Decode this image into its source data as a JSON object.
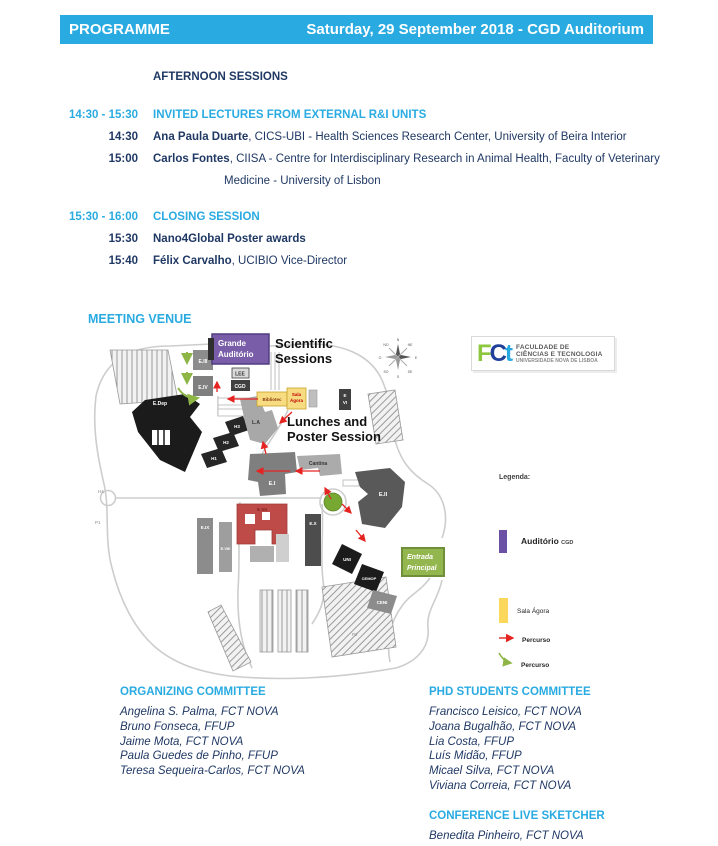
{
  "header": {
    "left": "PROGRAMME",
    "right": "Saturday, 29 September 2018 - CGD Auditorium"
  },
  "schedule": {
    "section_title": "AFTERNOON SESSIONS",
    "blocks": [
      {
        "time": "14:30 - 15:30",
        "title": "INVITED LECTURES FROM EXTERNAL R&I UNITS",
        "items": [
          {
            "time": "14:30",
            "bold": "Ana Paula Duarte",
            "normal": ", CICS-UBI - Health Sciences Research Center, University of Beira Interior",
            "continuation": ""
          },
          {
            "time": "15:00",
            "bold": "Carlos Fontes",
            "normal": ", CIISA - Centre for Interdisciplinary Research in Animal Health, Faculty of Veterinary",
            "continuation": "Medicine - University of Lisbon"
          }
        ]
      },
      {
        "time": "15:30 - 16:00",
        "title": "CLOSING SESSION",
        "items": [
          {
            "time": "15:30",
            "bold": "Nano4Global Poster awards",
            "normal": "",
            "continuation": ""
          },
          {
            "time": "15:40",
            "bold": "Félix Carvalho",
            "normal": ", UCIBIO Vice-Director",
            "continuation": ""
          }
        ]
      }
    ]
  },
  "venue": {
    "title": "MEETING VENUE",
    "map": {
      "labels": {
        "grande1": "Grande",
        "grande2": "Auditório",
        "scientific1": "Scientific",
        "scientific2": "Sessions",
        "lunches1": "Lunches and",
        "lunches2": "Poster Session",
        "entrada1": "Entrada",
        "entrada2": "Principal",
        "eiii": "E.III",
        "eiv": "E.IV",
        "lee": "LEE",
        "cgd": "CGD",
        "biblio": "Bibliotec",
        "agora1": "Sala",
        "agora2": "Ágora",
        "edep": "E.Dep",
        "h3": "H3",
        "h2": "H2",
        "h1": "H1",
        "la": "L.A",
        "ei": "E.I",
        "cantina": "Cantina",
        "eii": "E.II",
        "evii": "E.VII",
        "eix": "E.IX",
        "eviii": "E.VIII",
        "ex": "E.X",
        "evi1": "E",
        "evi2": "VI",
        "uni": "UNI",
        "cemop": "CEMOP",
        "ceni": "CENI",
        "h4": "H4",
        "p1": "P1",
        "p2": "P2"
      },
      "compass": {
        "n": "N",
        "ne": "NE",
        "e": "E",
        "se": "SE",
        "s": "S",
        "so": "SO",
        "o": "O",
        "no": "NO"
      }
    },
    "logo": {
      "f": "F",
      "c": "C",
      "t": "t",
      "line1": "FACULDADE DE",
      "line2": "CIÊNCIAS E TECNOLOGIA",
      "line3": "UNIVERSIDADE NOVA DE LISBOA"
    },
    "legend": {
      "title": "Legenda:",
      "auditorio": "Auditório",
      "auditorio_suffix": "CGD",
      "sala": "Sala Ágora",
      "percurso_red": "Percurso",
      "percurso_green": "Percurso"
    }
  },
  "committees": {
    "organizing": {
      "title": "ORGANIZING COMMITTEE",
      "members": [
        "Angelina S. Palma, FCT NOVA",
        "Bruno Fonseca, FFUP",
        "Jaime Mota, FCT NOVA",
        "Paula Guedes de Pinho, FFUP",
        "Teresa Sequeira-Carlos, FCT NOVA"
      ]
    },
    "phd": {
      "title": "PHD STUDENTS COMMITTEE",
      "members": [
        "Francisco Leisico, FCT NOVA",
        "Joana Bugalhão, FCT NOVA",
        "Lia Costa, FFUP",
        "Luís Midão, FFUP",
        "Micael Silva, FCT NOVA",
        "Viviana Correia, FCT NOVA"
      ]
    },
    "sketcher": {
      "title": "CONFERENCE LIVE SKETCHER",
      "members": [
        "Benedita Pinheiro, FCT NOVA"
      ]
    }
  },
  "colors": {
    "accent_cyan": "#29ABE2",
    "navy": "#1F3864",
    "map_purple": "#7A5DA8",
    "map_yellow": "#F7DC81",
    "route_red": "#E52421",
    "route_green": "#8DB646",
    "entrada_green": "#94B64E",
    "building_red": "#BE4B48"
  }
}
